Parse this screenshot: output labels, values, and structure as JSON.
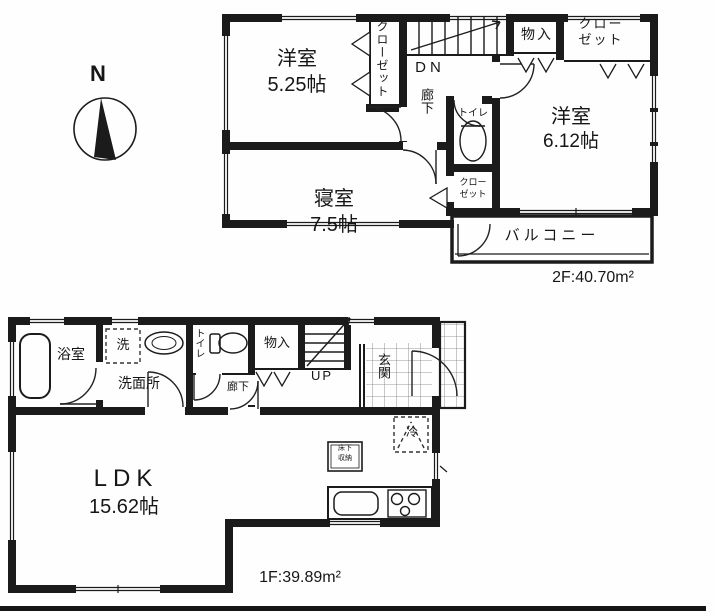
{
  "compass": {
    "north_label": "N"
  },
  "floor2": {
    "area_label": "2F:40.70m²",
    "rooms": {
      "western1": {
        "name": "洋室",
        "size": "5.25帖"
      },
      "western2": {
        "name": "洋室",
        "size": "6.12帖"
      },
      "bedroom": {
        "name": "寝室",
        "size": "7.5帖"
      },
      "closet_left": {
        "label": "クローゼット"
      },
      "closet_right": {
        "line1": "クロー",
        "line2": "ゼット"
      },
      "closet_small": {
        "line1": "クロー",
        "line2": "ゼット"
      },
      "storage": {
        "label": "物入"
      },
      "toilet": {
        "label": "トイレ"
      },
      "hallway": {
        "label": "廊下"
      },
      "stairs_down": {
        "label": "DN"
      },
      "balcony": {
        "label": "バルコニー"
      }
    }
  },
  "floor1": {
    "area_label": "1F:39.89m²",
    "rooms": {
      "ldk": {
        "name": "LDK",
        "size": "15.62帖"
      },
      "bath": {
        "label": "浴室"
      },
      "washer": {
        "label": "洗"
      },
      "washroom": {
        "label": "洗面所"
      },
      "toilet": {
        "label": "トイレ"
      },
      "hallway": {
        "label": "廊下"
      },
      "storage": {
        "label": "物入"
      },
      "stairs_up": {
        "label": "UP"
      },
      "entrance": {
        "label": "玄関"
      },
      "fridge": {
        "label": "冷"
      },
      "underfloor_storage": {
        "line1": "床下",
        "line2": "収納"
      }
    }
  }
}
